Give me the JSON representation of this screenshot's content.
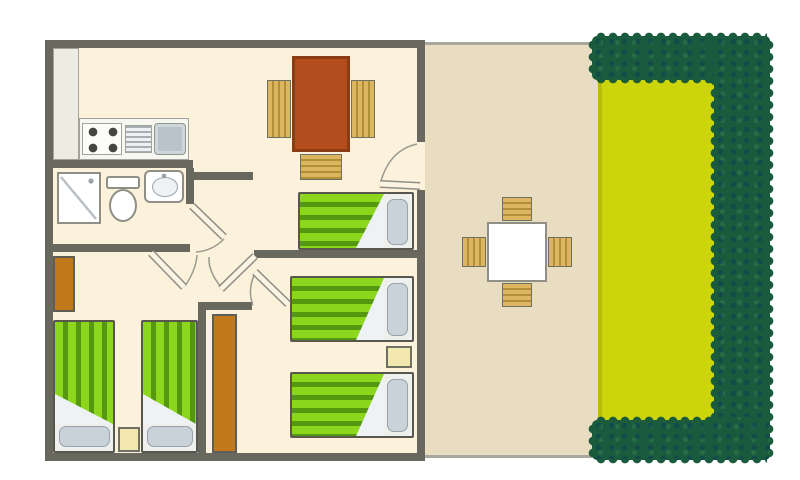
{
  "scene": {
    "type": "floor-plan"
  },
  "colors": {
    "wall": "#68685e",
    "wall_line": "#9a9a90",
    "floor": "#fcf1da",
    "unit": "#ecece2",
    "counter": "#f7f7f2",
    "burner": "#45453f",
    "sink": "#b9c3ca",
    "fixture_border": "#8f8f86",
    "terrace": "#e8ddc1",
    "terrace_line": "#a8a89e",
    "lawn": "#ccd40a",
    "lawn_edge": "#b6bd0c",
    "hedge": "#1a5b3d",
    "bed_light": "#8cd71e",
    "bed_dark": "#55970f",
    "bed_border": "#57574d",
    "pillow": "#c9d2d8",
    "pillow_border": "#98a2aa",
    "fold": "#eef2f5",
    "table_brown": "#b44d1d",
    "table_border": "#8a3c14",
    "chair": "#dcb65e",
    "chair_slat": "#b08f38",
    "chair_border": "#6f6f64",
    "wardrobe": "#c1791c",
    "wardrobe_border": "#5e5e54",
    "nightstand": "#f2e8af"
  },
  "floorplan": {
    "rooms": [
      {
        "name": "kitchen",
        "items": [
          "tall-unit",
          "stove-4-burners",
          "drainer",
          "sink"
        ]
      },
      {
        "name": "bathroom",
        "items": [
          "shower",
          "toilet",
          "washbasin"
        ]
      },
      {
        "name": "living-dining",
        "items": [
          "dining-table",
          "chair",
          "chair",
          "chair"
        ]
      },
      {
        "name": "bedroom-middle",
        "items": [
          "single-bed"
        ]
      },
      {
        "name": "bedroom-bottom-right",
        "items": [
          "single-bed",
          "single-bed",
          "nightstand",
          "wardrobe"
        ]
      },
      {
        "name": "bedroom-bottom-left",
        "items": [
          "single-bed",
          "single-bed",
          "nightstand",
          "wardrobe"
        ]
      },
      {
        "name": "terrace",
        "items": [
          "garden-table",
          "garden-chair",
          "garden-chair",
          "garden-chair",
          "garden-chair"
        ]
      },
      {
        "name": "garden",
        "items": [
          "lawn",
          "hedge"
        ]
      }
    ],
    "counts": {
      "beds": 5,
      "doors": 5,
      "dining_chairs": 3,
      "terrace_chairs": 4
    }
  }
}
